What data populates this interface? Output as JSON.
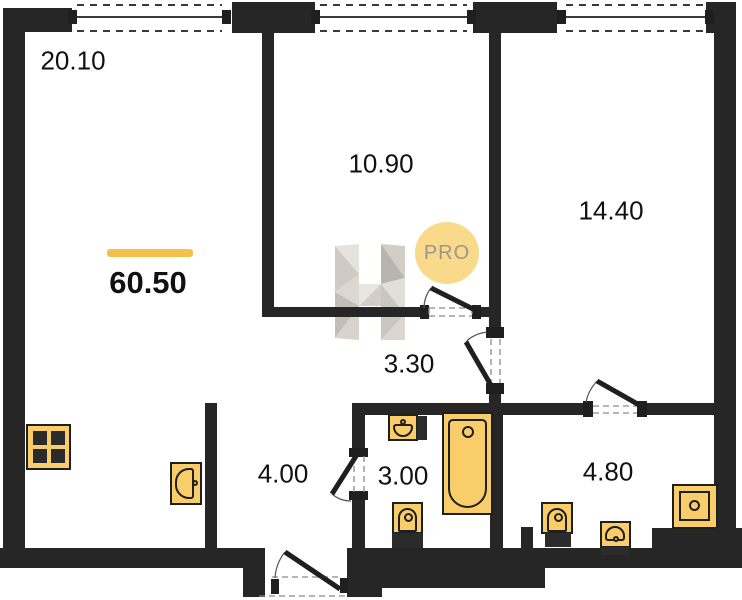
{
  "floorplan": {
    "total_area": "60.50",
    "rooms": {
      "living": "20.10",
      "bedroom_1": "10.90",
      "bedroom_2": "14.40",
      "hallway": "3.30",
      "corridor": "4.00",
      "bathroom_1": "3.00",
      "bathroom_2": "4.80"
    },
    "badge": {
      "text": "PRO"
    },
    "colors": {
      "wall": "#262626",
      "fixture_fill": "#F9CD69",
      "fixture_border": "#1F1F1F",
      "area_accent_bar": "#F2C24E",
      "badge_fill": "#F8DA8A",
      "badge_text": "#9C968D",
      "watermark_gray": "#D5D1CA"
    }
  }
}
